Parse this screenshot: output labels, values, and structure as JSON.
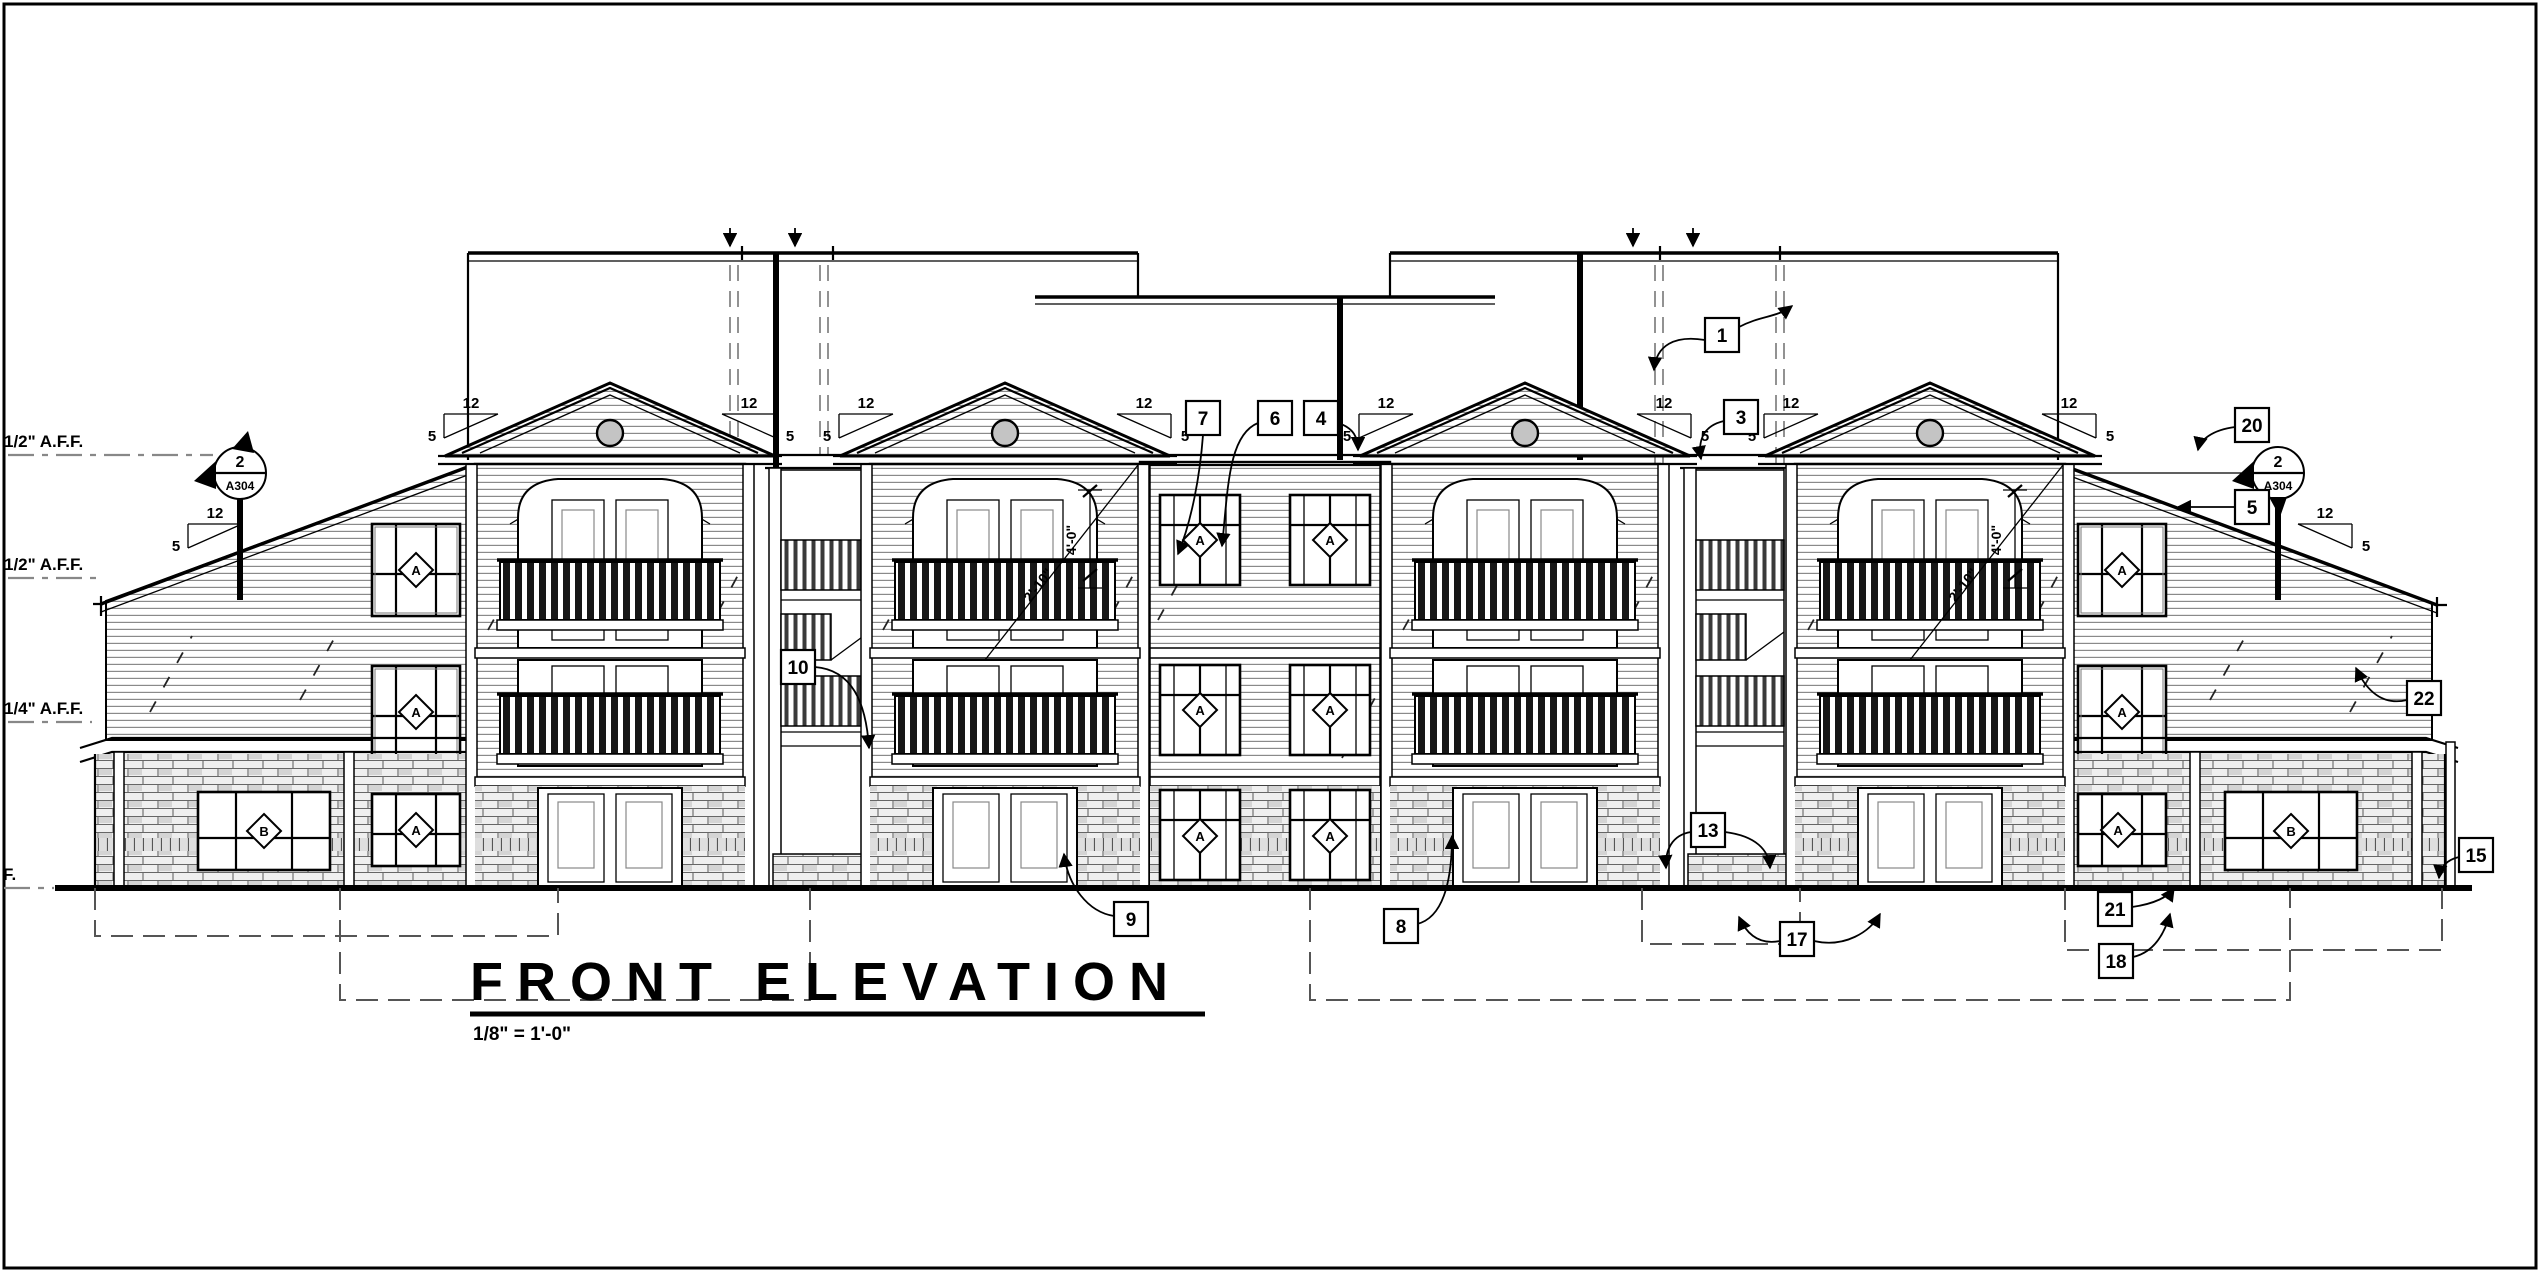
{
  "drawing_type": "architectural front elevation sheet",
  "title_block": {
    "title": "FRONT ELEVATION",
    "scale": "1/8\" = 1'-0\""
  },
  "annotations": {
    "datum_labels": [
      {
        "text": "1/2\" A.F.F."
      },
      {
        "text": "1/2\" A.F.F."
      },
      {
        "text": "1/4\" A.F.F."
      },
      {
        "text": "F."
      }
    ],
    "section_marker": {
      "detail_number": "2",
      "sheet_number": "A304"
    },
    "pitch_marker": {
      "rise": "12",
      "run": "5"
    },
    "window_tags": {
      "a": "A",
      "b": "B"
    },
    "dimensions": {
      "vertical": "4'-0\"",
      "diagonal": "2'-10\""
    },
    "callouts": [
      {
        "number": "1"
      },
      {
        "number": "3"
      },
      {
        "number": "4"
      },
      {
        "number": "5"
      },
      {
        "number": "6"
      },
      {
        "number": "7"
      },
      {
        "number": "8"
      },
      {
        "number": "9"
      },
      {
        "number": "10"
      },
      {
        "number": "13"
      },
      {
        "number": "15"
      },
      {
        "number": "17"
      },
      {
        "number": "18"
      },
      {
        "number": "20"
      },
      {
        "number": "21"
      },
      {
        "number": "22"
      }
    ]
  },
  "colors": {
    "ink": "#000000",
    "texture_gray": "#8a8a8a",
    "datum_gray": "#888888",
    "paper": "#ffffff"
  }
}
